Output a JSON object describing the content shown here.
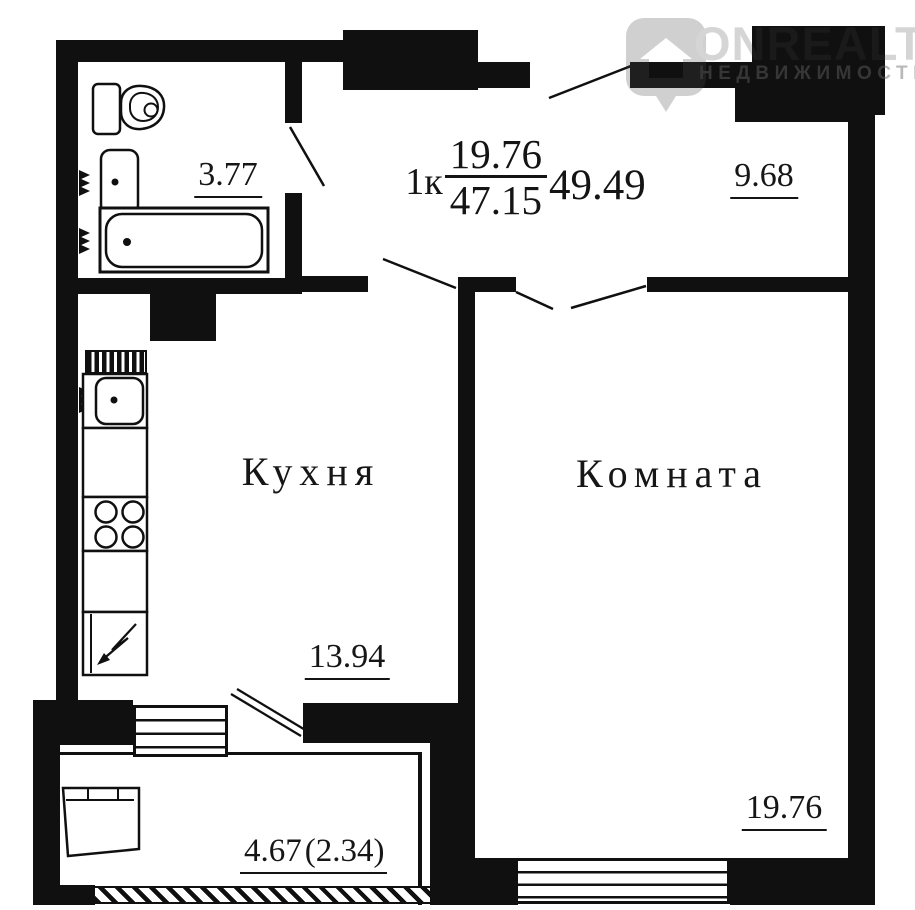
{
  "watermark": {
    "brand": "ONREALT",
    "subtitle": "НЕДВИЖИМОСТЬ"
  },
  "title": {
    "rooms": "1к",
    "living_area": "19.76",
    "total_area": "47.15",
    "total_with_balcony": "49.49"
  },
  "rooms": {
    "bathroom": {
      "area": "3.77"
    },
    "hallway": {
      "area": "9.68"
    },
    "kitchen": {
      "name": "Кухня",
      "area": "13.94"
    },
    "living_room": {
      "name": "Комната",
      "area": "19.76"
    },
    "balcony": {
      "area_full": "4.67",
      "area_coefficient": "(2.34)"
    }
  },
  "colors": {
    "walls": "#101010",
    "background": "#ffffff",
    "watermark_gray": "#2a2a2a"
  }
}
